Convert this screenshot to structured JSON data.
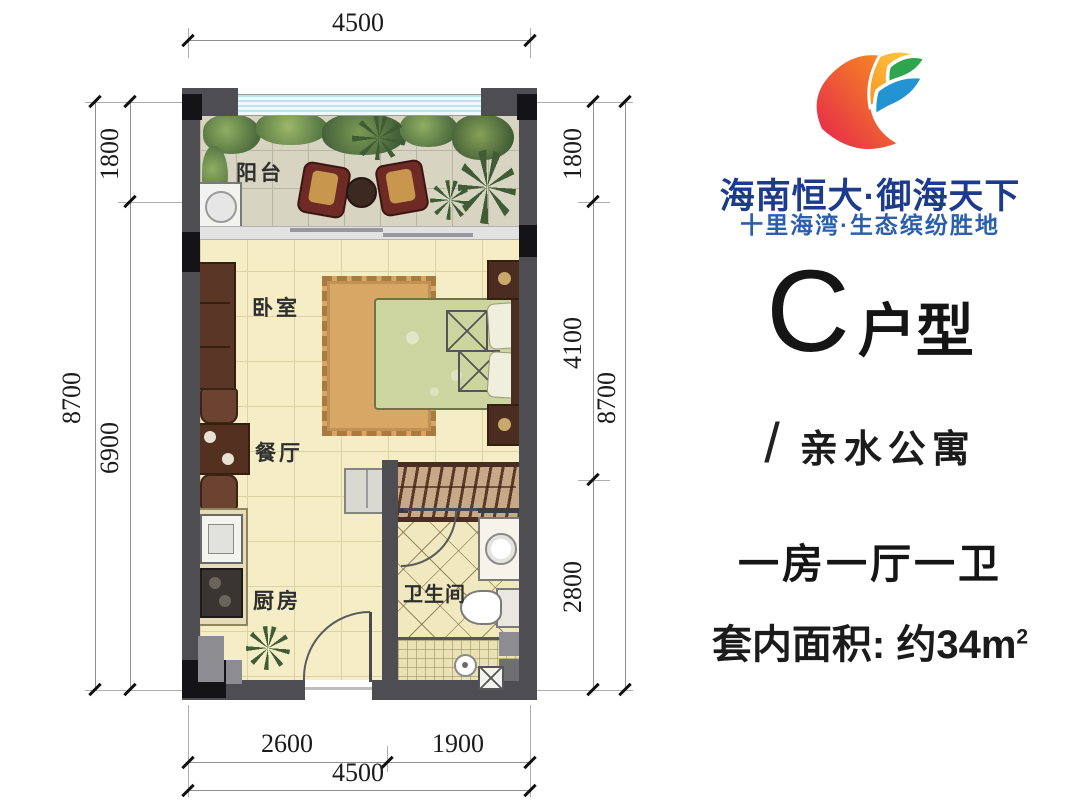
{
  "branding": {
    "title": "海南恒大·御海天下",
    "subtitle": "十里海湾·生态缤纷胜地",
    "title_color": "#1c3b8d",
    "subtitle_color": "#2a5fae"
  },
  "unit": {
    "letter": "C",
    "suffix": "户型",
    "slash": "/",
    "category": "亲水公寓",
    "rooms_line": "一房一厅一卫",
    "area_prefix": "套内面积: 约34m",
    "area_sup": "2"
  },
  "plan": {
    "labels": {
      "balcony": "阳台",
      "bedroom": "卧室",
      "dining": "餐厅",
      "kitchen": "厨房",
      "bathroom": "卫生间"
    },
    "dims": {
      "top_total": "4500",
      "left_total": "8700",
      "left_seg1": "1800",
      "left_seg2": "6900",
      "right_seg1": "1800",
      "right_seg2": "4100",
      "right_seg3": "2800",
      "right_total": "8700",
      "bottom_seg1": "2600",
      "bottom_seg2": "1900",
      "bottom_total": "4500"
    },
    "wall_color": "#4e4e52"
  }
}
